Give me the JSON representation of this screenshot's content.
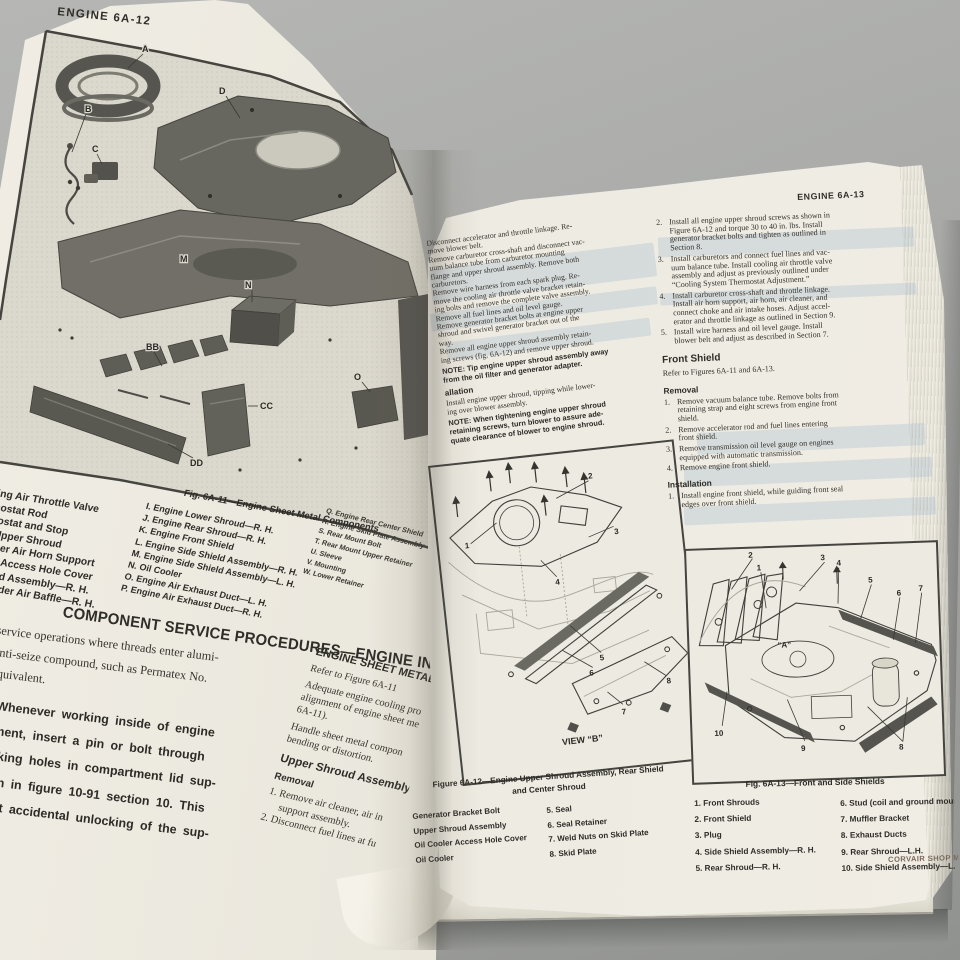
{
  "colors": {
    "table": "#a9aaa8",
    "paper_left": "#e9e6dc",
    "paper_right": "#edeae1",
    "ink": "#2f2d29",
    "footer_ink": "#7a695b",
    "ghost_blue": "#94b0c6",
    "border_ink": "#45443f"
  },
  "left_page": {
    "header": "ENGINE 6A-12",
    "fig11": {
      "caption": "Fig. 6A-11—Engine Sheet Metal Components",
      "labels": {
        "a": "A",
        "b": "B",
        "c": "C",
        "d": "D",
        "m": "M",
        "n": "N",
        "bb": "BB",
        "cc": "CC",
        "dd": "DD",
        "o": "O"
      },
      "legend_col1": [
        "ling Air Throttle Valve",
        "mostat Rod",
        "mostat and Stop",
        "e Upper Shroud",
        "eaner Air Horn Support",
        "oler Access Hole Cover",
        "hroud Assembly—R. H.",
        "Cylinder Air Baffle—R. H."
      ],
      "legend_col2": [
        "I. Engine Lower Shroud—R. H.",
        "J. Engine Rear Shroud—R. H.",
        "K. Engine Front Shield",
        "L. Engine Side Shield Assembly—R. H.",
        "M. Engine Side Shield Assembly—L. H.",
        "N. Oil Cooler",
        "O. Engine Air Exhaust Duct—L. H.",
        "P. Engine Air Exhaust Duct—R. H."
      ],
      "legend_col3": [
        "Q. Engine Rear Center Shield",
        "R. Engine Skid Plate Assembly",
        "S. Rear Mount Bolt",
        "T. Rear Mount Upper Retainer",
        "U. Sleeve",
        "V. Mounting",
        "W. Lower Retainer"
      ]
    },
    "service_heading": "COMPONENT SERVICE PROCEDURES—ENGINE IN VEHI",
    "para1": [
      "service operations where threads enter alumi-",
      "anti-seize compound, such as Permatex No.",
      "equivalent."
    ],
    "para2": [
      "Whenever working inside of engine",
      "ment, insert a pin or bolt through",
      "cking holes in compartment lid sup-",
      "wn in figure 10-91 section 10. This",
      "ent accidental unlocking of the sup-"
    ],
    "col2": {
      "heading": "ENGINE SHEET METAL COM",
      "refer": "Refer to Figure 6A-11",
      "para1": [
        "Adequate engine cooling pro",
        "alignment of engine sheet me",
        "6A-11)."
      ],
      "para2": [
        "Handle sheet metal compon",
        "bending or distortion."
      ],
      "assembly_heading": "Upper Shroud Assembly",
      "removal_heading": "Removal",
      "items": [
        "1.  Remove air cleaner, air in",
        "support assembly.",
        "2.  Disconnect fuel lines at fu"
      ]
    }
  },
  "mid_col": {
    "para1": [
      "Disconnect accelerator and throttle linkage. Re-",
      "move blower belt.",
      "Remove carburetor cross-shaft and disconnect vac-",
      "uum balance tube from carburetor mounting",
      "flange and upper shroud assembly. Remove both",
      "carburetors.",
      "Remove wire harness from each spark plug. Re-",
      "move the cooling air throttle valve bracket retain-",
      "ing bolts and remove the complete valve assembly.",
      "Remove all fuel lines and oil level gauge.",
      "Remove generator bracket bolts at engine upper",
      "shroud and swivel generator bracket out of the",
      "way.",
      "Remove all engine upper shroud assembly retain-",
      "ing screws (fig. 6A-12) and remove upper shroud."
    ],
    "note1": [
      "NOTE: Tip engine upper shroud assembly away",
      "from the oil filter and generator adapter."
    ],
    "install_frag": "allation",
    "para2": [
      "Install engine upper shroud, tipping while lower-",
      "ing over blower assembly."
    ],
    "note2": [
      "NOTE: When tightening engine upper shroud",
      "retaining screws, turn blower to assure ade-",
      "quate clearance of blower to engine shroud."
    ]
  },
  "right_col": {
    "header": "ENGINE 6A-13",
    "items": [
      {
        "num": "2.",
        "lines": [
          "Install all engine upper shroud screws as shown in",
          "Figure 6A-12 and torque 30 to 40 in. lbs. Install",
          "generator bracket bolts and tighten as outlined in",
          "Section 8."
        ]
      },
      {
        "num": "3.",
        "lines": [
          "Install carburetors and connect fuel lines and vac-",
          "uum balance tube. Install cooling air throttle valve",
          "assembly and adjust as previously outlined under",
          "“Cooling System Thermostat Adjustment.”"
        ]
      },
      {
        "num": "4.",
        "lines": [
          "Install carburetor cross-shaft and throttle linkage.",
          "Install air horn support, air horn, air cleaner, and",
          "connect choke and air intake hoses. Adjust accel-",
          "erator and throttle linkage as outlined in Section 9."
        ]
      },
      {
        "num": "5.",
        "lines": [
          "Install wire harness and oil level gauge. Install",
          "blower belt and adjust as described in Section 7."
        ]
      }
    ],
    "front_shield_heading": "Front Shield",
    "refer": "Refer to Figures 6A-11 and 6A-13.",
    "removal_heading": "Removal",
    "removal_items": [
      {
        "num": "1.",
        "lines": [
          "Remove vacuum balance tube. Remove bolts from",
          "retaining strap and eight screws from engine front",
          "shield."
        ]
      },
      {
        "num": "2.",
        "lines": [
          "Remove accelerator rod and fuel lines entering",
          "front shield."
        ]
      },
      {
        "num": "3.",
        "lines": [
          "Remove transmission oil level gauge on engines",
          "equipped with automatic transmission."
        ]
      },
      {
        "num": "4.",
        "lines": [
          "Remove engine front shield."
        ]
      }
    ],
    "installation_heading": "Installation",
    "installation_items": [
      {
        "num": "1.",
        "lines": [
          "Install engine front shield, while guiding front seal",
          "edges over front shield."
        ]
      }
    ]
  },
  "fig12": {
    "caption1": "Figure 6A-12—Engine Upper Shroud Assembly, Rear Shield",
    "caption2": "and Center Shroud",
    "view_label": "VIEW “B”",
    "callouts": [
      "1",
      "2",
      "3",
      "4",
      "5",
      "6",
      "7",
      "8"
    ],
    "legend_col1": [
      "Generator Bracket Bolt",
      "Upper Shroud Assembly",
      "Oil Cooler Access Hole Cover",
      "Oil Cooler"
    ],
    "legend_col2": [
      "5. Seal",
      "6. Seal Retainer",
      "7. Weld Nuts on Skid Plate",
      "8. Skid Plate"
    ]
  },
  "fig13": {
    "caption": "Fig. 6A-13—Front and Side Shields",
    "view_label": "“A”",
    "callouts": [
      "1",
      "2",
      "3",
      "4",
      "5",
      "6",
      "7",
      "8",
      "9",
      "10"
    ],
    "legend_col1": [
      "1. Front Shrouds",
      "2. Front Shield",
      "3. Plug",
      "4. Side Shield Assembly—R. H.",
      "5. Rear Shroud—R. H."
    ],
    "legend_col2": [
      "6. Stud (coil and ground mounting",
      "7. Muffler Bracket",
      "8. Exhaust Ducts",
      "9. Rear Shroud—L.H.",
      "10. Side Shield Assembly—L. H."
    ]
  },
  "footer": "CORVAIR SHOP MA"
}
